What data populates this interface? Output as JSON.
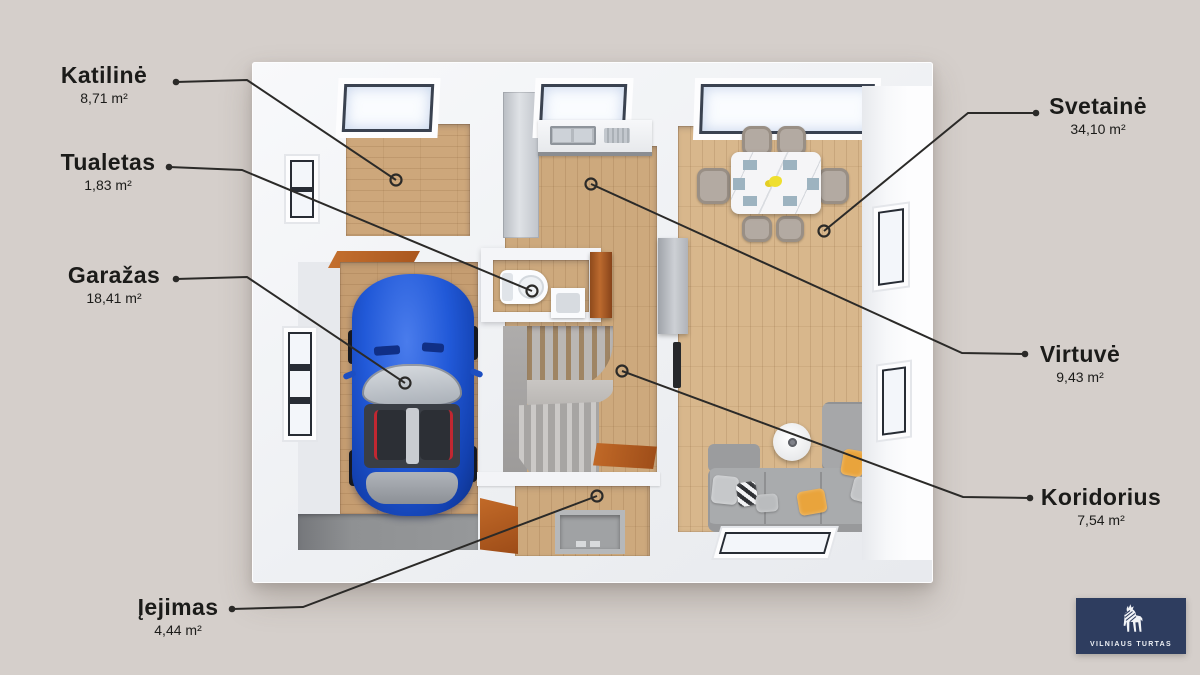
{
  "annotations": [
    {
      "id": "katiline",
      "title": "Katilinė",
      "area": "8,71 m²",
      "side": "left",
      "cx": 104,
      "top": 63,
      "dot": [
        176,
        82
      ],
      "bend": [
        247,
        80
      ],
      "target": [
        396,
        180
      ]
    },
    {
      "id": "tualetas",
      "title": "Tualetas",
      "area": "1,83 m²",
      "side": "left",
      "cx": 108,
      "top": 150,
      "dot": [
        169,
        167
      ],
      "bend": [
        242,
        170
      ],
      "target": [
        532,
        291
      ]
    },
    {
      "id": "garazas",
      "title": "Garažas",
      "area": "18,41 m²",
      "side": "left",
      "cx": 114,
      "top": 263,
      "dot": [
        176,
        279
      ],
      "bend": [
        247,
        277
      ],
      "target": [
        405,
        383
      ]
    },
    {
      "id": "iejimas",
      "title": "Įejimas",
      "area": "4,44 m²",
      "side": "left",
      "cx": 178,
      "top": 595,
      "dot": [
        232,
        609
      ],
      "bend": [
        303,
        607
      ],
      "target": [
        597,
        496
      ]
    },
    {
      "id": "svetaine",
      "title": "Svetainė",
      "area": "34,10 m²",
      "side": "right",
      "cx": 1098,
      "top": 94,
      "dot": [
        1036,
        113
      ],
      "bend": [
        968,
        113
      ],
      "target": [
        824,
        231
      ]
    },
    {
      "id": "virtuve",
      "title": "Virtuvė",
      "area": "9,43 m²",
      "side": "right",
      "cx": 1080,
      "top": 342,
      "dot": [
        1025,
        354
      ],
      "bend": [
        962,
        353
      ],
      "target": [
        591,
        184
      ]
    },
    {
      "id": "koridorius",
      "title": "Koridorius",
      "area": "7,54 m²",
      "side": "right",
      "cx": 1101,
      "top": 485,
      "dot": [
        1030,
        498
      ],
      "bend": [
        963,
        497
      ],
      "target": [
        622,
        371
      ]
    }
  ],
  "logo": {
    "text": "VILNIAUS TURTAS",
    "icon": "wolf-icon",
    "bg": "#2e3d5f"
  },
  "colors": {
    "background": "#d5cfcb",
    "wall": "#f4f5f8",
    "leader_line": "#2b2a28",
    "text": "#1b1b19",
    "wood_living": "#d8b78c",
    "wood_hall": "#cda97d",
    "wood_garage": "#c59d71",
    "wood_boiler": "#cda77b",
    "car_blue": "#1e55d4",
    "sofa_gray": "#a9abad",
    "pillow_orange": "#e9a43c",
    "door_brown": "#b0601f",
    "logo_navy": "#2e3d5f"
  }
}
